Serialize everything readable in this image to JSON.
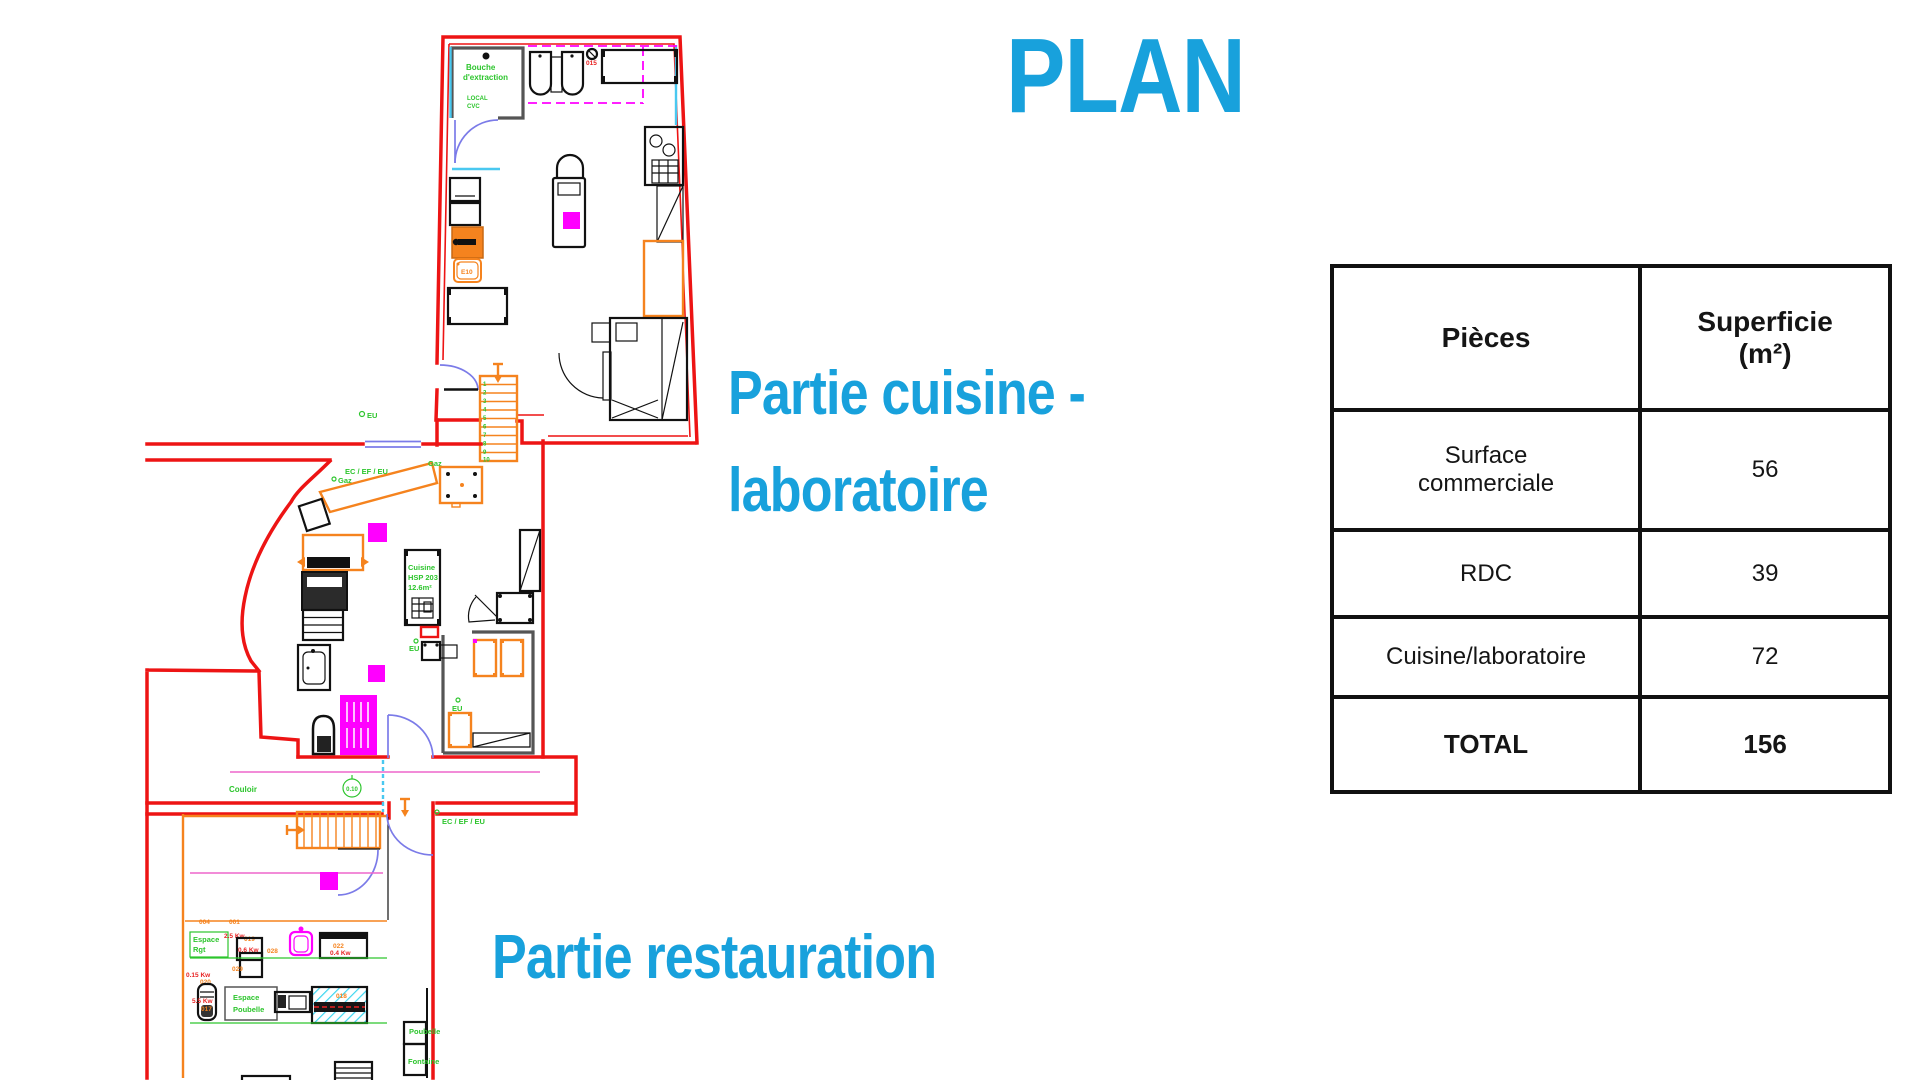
{
  "title": "PLAN",
  "annotations": {
    "cuisine_line1": "Partie cuisine -",
    "cuisine_line2": "laboratoire",
    "restauration": "Partie restauration"
  },
  "table": {
    "headers": [
      "Pièces",
      "Superficie (m²)"
    ],
    "rows": [
      {
        "piece": "Surface commerciale",
        "area": "56"
      },
      {
        "piece": "RDC",
        "area": "39"
      },
      {
        "piece": "Cuisine/laboratoire",
        "area": "72"
      },
      {
        "piece": "TOTAL",
        "area": "156"
      }
    ]
  },
  "plan": {
    "top_room": {
      "bouche1": "Bouche",
      "bouche2": "d'extraction",
      "local": "LOCAL",
      "cvc": "CVC",
      "e10": "E10",
      "circle_id": "015",
      "eu": "EU"
    },
    "middle": {
      "ec_ef_eu": "EC / EF / EU",
      "gaz1": "Gaz",
      "gaz2": "Gaz",
      "cuisine1": "Cuisine",
      "cuisine2": "HSP 203",
      "cuisine3": "12.6m²",
      "eu1": "EU",
      "eu2": "EU",
      "couloir": "Couloir",
      "cote": "0.10"
    },
    "bottom": {
      "ec_ef_eu": "EC / EF / EU",
      "l004": "004",
      "l001": "001",
      "espace1": "Espace",
      "rgt": "Rgt",
      "kw25": "2.5 Kw",
      "id019": "019",
      "kw06": "0.6 Kw",
      "id029": "029",
      "id028": "028",
      "id022": "022",
      "kw04": "0.4 Kw",
      "kw015": "0.15 Kw",
      "id020": "020",
      "kw55": "5.5 Kw",
      "id017": "017",
      "id018": "018",
      "espace2": "Espace",
      "poubelle2": "Poubelle",
      "poubelle": "Poubelle",
      "fontaine": "Fontaine"
    },
    "stair_numbers": [
      "1",
      "2",
      "3",
      "4",
      "5",
      "6",
      "7",
      "8",
      "9",
      "10"
    ]
  },
  "colors": {
    "accent_blue": "#18A1DC",
    "wall_red": "#ED1414",
    "fixture_orange": "#F5831E",
    "highlight_magenta": "#FF00FF",
    "cad_green": "#2DC52D",
    "door_blue": "#7B7BE8",
    "window_cyan": "#49C8F0",
    "table_border": "#111111"
  }
}
